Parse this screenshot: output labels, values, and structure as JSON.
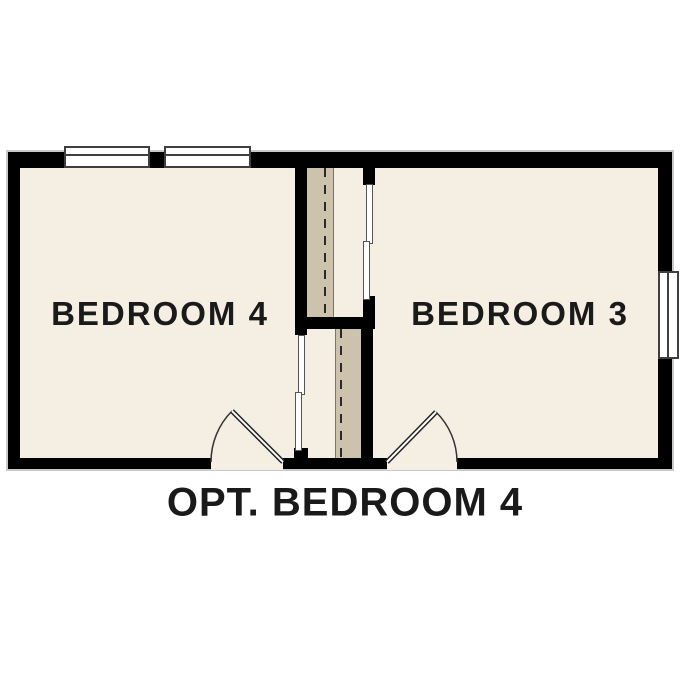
{
  "floor_plan": {
    "caption": "OPT. BEDROOM 4",
    "rooms": [
      {
        "label": "BEDROOM 4"
      },
      {
        "label": "BEDROOM 3"
      }
    ],
    "features": {
      "windows": 3,
      "doors": 2,
      "stair_shaft_dashed_lines": 2
    }
  },
  "colors": {
    "background": "#ffffff",
    "wall": "#000000",
    "floor": "#f5eee3",
    "stair_shaft": "#cdc2ac",
    "trim": "#3f3f3f",
    "outline": "#c9c9c9",
    "text": "#1a1a1a"
  }
}
